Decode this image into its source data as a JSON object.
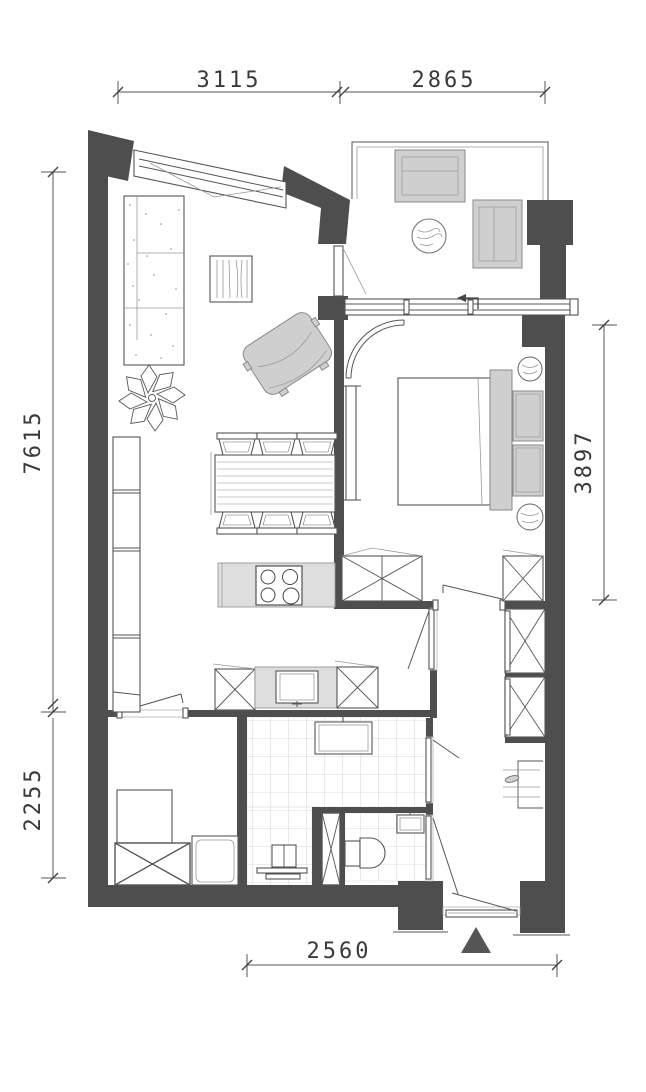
{
  "plan": {
    "dimensions": {
      "top_left": "3115",
      "top_right": "2865",
      "left_upper": "7615",
      "left_lower": "2255",
      "right_side": "3897",
      "bottom": "2560"
    },
    "icons": {
      "entrance_marker": "triangle-up"
    },
    "colors": {
      "wall": "#4e4e4e",
      "furniture": "#cfcfcf",
      "counter": "#dedede",
      "line": "#555555",
      "tile_line": "#cccccc",
      "dim_text": "#3a3a3a",
      "background": "#ffffff"
    }
  }
}
